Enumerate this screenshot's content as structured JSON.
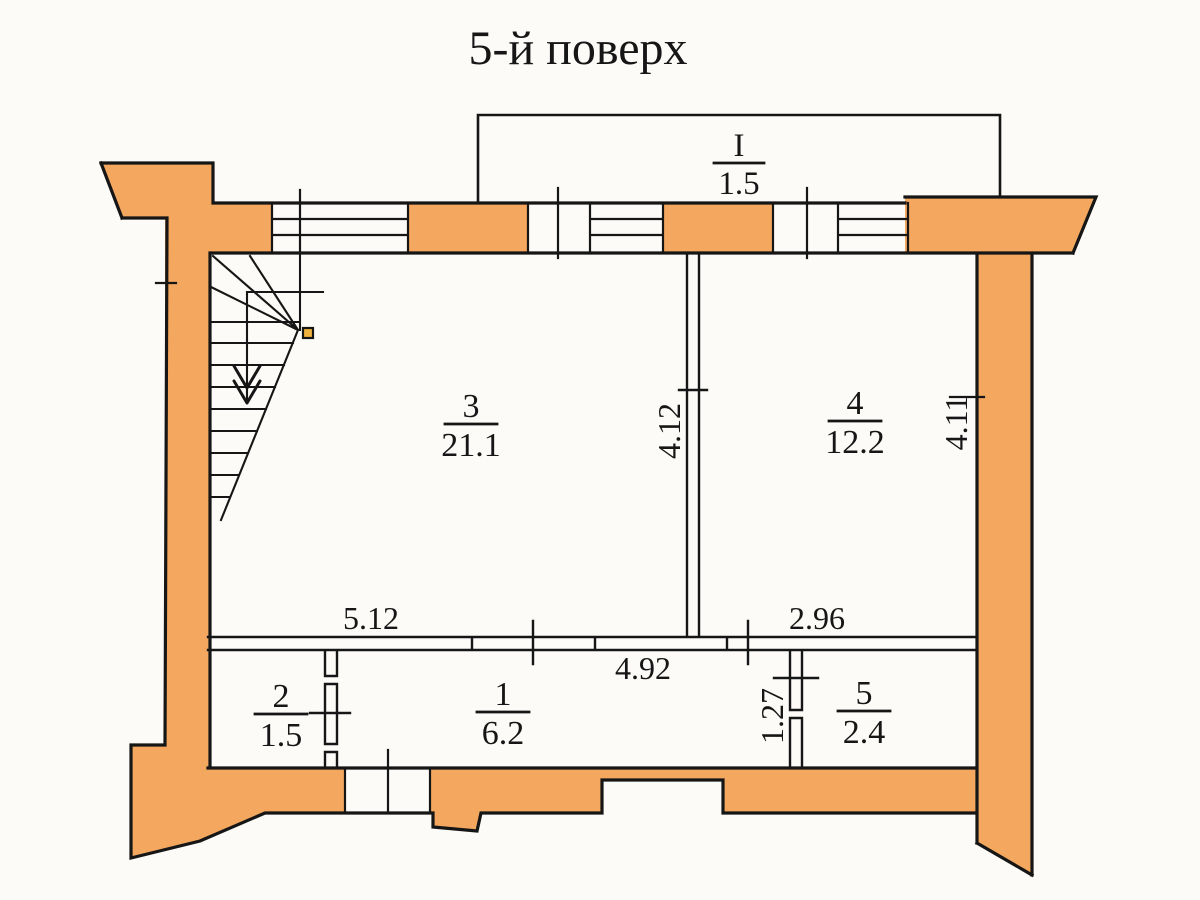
{
  "title": "5-й поверх",
  "balcony": {
    "number": "I",
    "area": "1.5"
  },
  "rooms": {
    "r3": {
      "number": "3",
      "area": "21.1"
    },
    "r4": {
      "number": "4",
      "area": "12.2"
    },
    "r2": {
      "number": "2",
      "area": "1.5"
    },
    "r1": {
      "number": "1",
      "area": "6.2"
    },
    "r5": {
      "number": "5",
      "area": "2.4"
    }
  },
  "dimensions": {
    "span_left": "5.12",
    "span_right": "2.96",
    "span_corridor": "4.92",
    "depth_room3": "4.12",
    "depth_room4": "4.11",
    "offset_room5": "1.27"
  },
  "colors": {
    "wall": "#f4a75e",
    "marker": "#f2b23e",
    "line": "#161616",
    "paper": "#fcfbf8"
  }
}
